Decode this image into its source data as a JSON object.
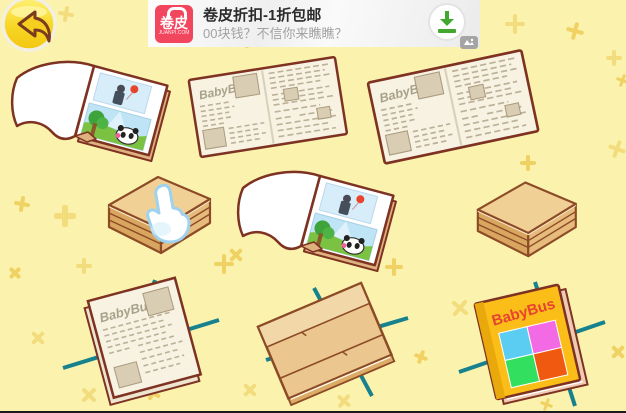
{
  "brand": "BabyBus",
  "back_button": {
    "icon": "back-arrow"
  },
  "ad_banner": {
    "logo": {
      "text": "卷皮",
      "domain": "JUANPI.COM"
    },
    "title": "卷皮折扣-1折包邮",
    "subtitle": "00块钱？不信你来瞧瞧？",
    "download_icon": "download-arrow",
    "corner_badge_icon": "ad-provider-badge"
  },
  "scene": {
    "items": [
      {
        "id": "open-picture-book-1"
      },
      {
        "id": "open-newspaper-1",
        "masthead": "BabyBus"
      },
      {
        "id": "open-newspaper-2",
        "masthead": "BabyBus"
      },
      {
        "id": "folded-box-with-hand",
        "hint_icon": "hand-pointer"
      },
      {
        "id": "open-picture-book-2"
      },
      {
        "id": "folded-box"
      },
      {
        "id": "newspaper-bundle-on-strings",
        "masthead": "BabyBus"
      },
      {
        "id": "folded-sheet-on-strings"
      },
      {
        "id": "finished-book-on-strings",
        "cover_title": "BabyBus"
      }
    ]
  },
  "colors": {
    "background": "#FBF3AD",
    "sparkle": "#F0D163",
    "outline_maroon": "#7E3222",
    "newsprint": "#F7F2E2",
    "scribble": "#BCB198",
    "photo_tan": "#D9CDB3",
    "box_top": "#F1D096",
    "box_front": "#E6BB7C",
    "box_side": "#D9A660",
    "string_teal": "#17818E",
    "cover_yellow": "#FBBE18",
    "cover_title_red": "#E84230",
    "square_cyan": "#5BCDF2",
    "square_pink": "#F26BE4",
    "square_green": "#33DF5F",
    "square_orange": "#F05A10",
    "ad_logo_red": "#F2455E",
    "download_green": "#41A72F"
  },
  "background": {
    "sparkles": [
      {
        "x": 58,
        "y": 6,
        "s": 16,
        "r": 10,
        "c": "#F3DC7E"
      },
      {
        "x": 238,
        "y": 30,
        "s": 18,
        "r": 0,
        "c": "#F0D163"
      },
      {
        "x": 505,
        "y": 14,
        "s": 20,
        "r": 0,
        "c": "#F3DC7E"
      },
      {
        "x": 566,
        "y": 22,
        "s": 18,
        "r": 15,
        "c": "#F0D163"
      },
      {
        "x": 606,
        "y": 50,
        "s": 16,
        "r": 0,
        "c": "#F3DC7E"
      },
      {
        "x": 616,
        "y": 74,
        "s": 13,
        "r": 20,
        "c": "#F0D163"
      },
      {
        "x": 14,
        "y": 196,
        "s": 16,
        "r": 10,
        "c": "#F0D163"
      },
      {
        "x": 54,
        "y": 205,
        "s": 22,
        "r": 0,
        "c": "#F3DC7E"
      },
      {
        "x": 228,
        "y": 247,
        "s": 16,
        "r": 45,
        "c": "#F0D163"
      },
      {
        "x": 608,
        "y": 140,
        "s": 18,
        "r": 20,
        "c": "#F3DC7E"
      },
      {
        "x": 520,
        "y": 155,
        "s": 16,
        "r": 0,
        "c": "#F0D163"
      },
      {
        "x": 8,
        "y": 266,
        "s": 14,
        "r": 45,
        "c": "#F0D163"
      },
      {
        "x": 76,
        "y": 258,
        "s": 16,
        "r": 0,
        "c": "#F3DC7E"
      },
      {
        "x": 214,
        "y": 254,
        "s": 20,
        "r": 0,
        "c": "#F0D163"
      },
      {
        "x": 30,
        "y": 330,
        "s": 16,
        "r": 45,
        "c": "#F3DC7E"
      },
      {
        "x": 102,
        "y": 332,
        "s": 18,
        "r": 30,
        "c": "#F0D163"
      },
      {
        "x": 80,
        "y": 386,
        "s": 18,
        "r": 45,
        "c": "#F3DC7E"
      },
      {
        "x": 145,
        "y": 385,
        "s": 16,
        "r": 30,
        "c": "#F0D163"
      },
      {
        "x": 242,
        "y": 382,
        "s": 16,
        "r": 45,
        "c": "#F3DC7E"
      },
      {
        "x": 385,
        "y": 258,
        "s": 18,
        "r": 0,
        "c": "#F0D163"
      },
      {
        "x": 450,
        "y": 298,
        "s": 20,
        "r": 40,
        "c": "#F3DC7E"
      },
      {
        "x": 610,
        "y": 344,
        "s": 16,
        "r": 45,
        "c": "#F0D163"
      },
      {
        "x": 512,
        "y": 385,
        "s": 16,
        "r": 30,
        "c": "#F3DC7E"
      },
      {
        "x": 414,
        "y": 350,
        "s": 14,
        "r": 20,
        "c": "#F0D163"
      },
      {
        "x": 336,
        "y": 393,
        "s": 16,
        "r": 40,
        "c": "#F3DC7E"
      },
      {
        "x": 540,
        "y": 398,
        "s": 13,
        "r": 20,
        "c": "#F0D163"
      }
    ]
  }
}
